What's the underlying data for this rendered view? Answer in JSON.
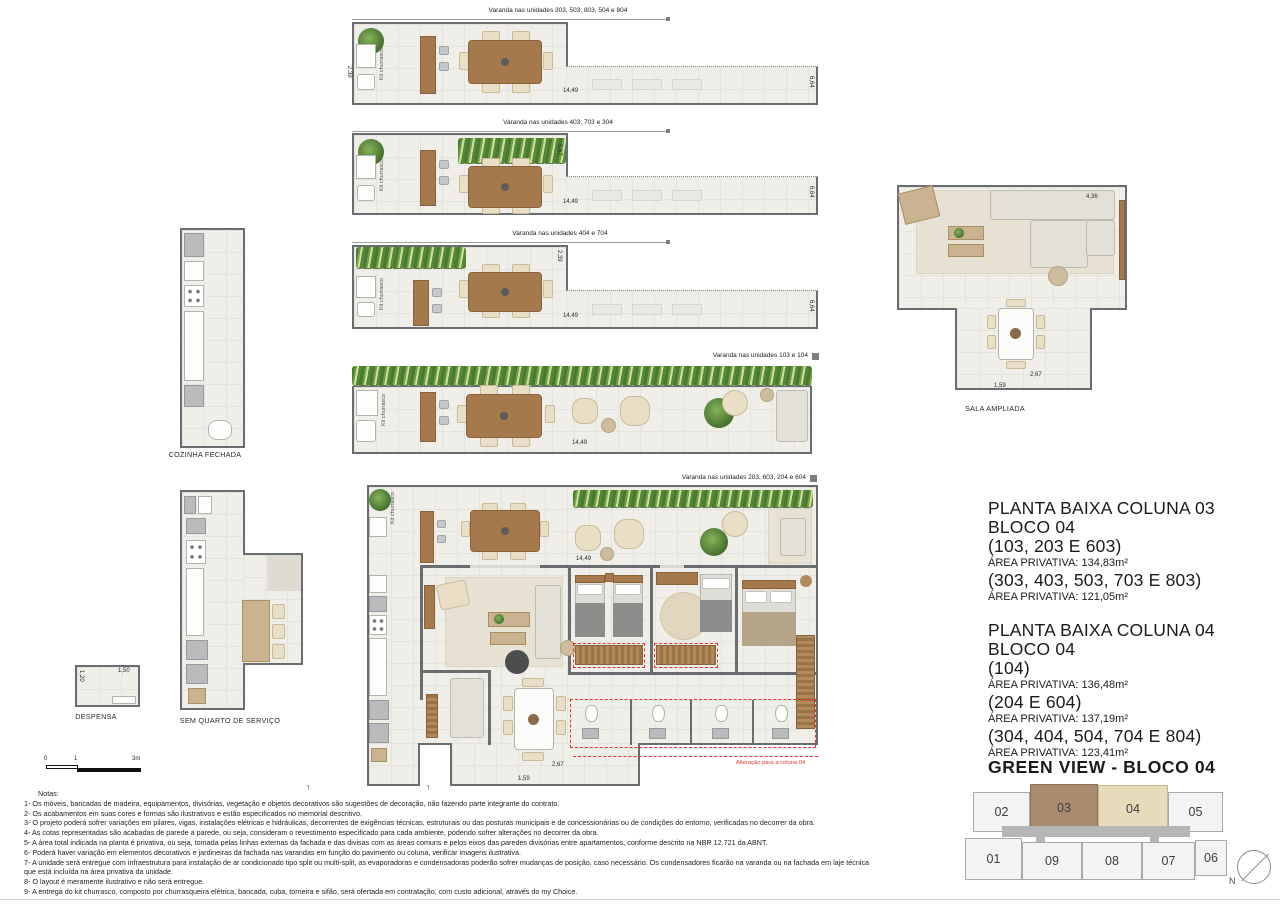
{
  "labels": {
    "varanda1": "Varanda nas unidades 303, 503, 803, 504 e 804",
    "varanda2": "Varanda nas unidades 403, 703 e 304",
    "varanda3": "Varanda nas unidades 404 e 704",
    "varanda4": "Varanda nas unidades 103 e 104",
    "varanda_main": "Varanda nas unidades 203, 603, 204 e 604",
    "kit": "Kit churrasco",
    "cozinha": "COZINHA FECHADA",
    "despensa": "DESPENSA",
    "sem_quarto": "SEM QUARTO DE SERVIÇO",
    "sala": "SALA AMPLIADA",
    "alteracao": "Alteração para a coluna 04"
  },
  "dims": {
    "d1449": "14,49",
    "d664": "6,64",
    "d567": "5,67",
    "d239": "2,39",
    "d436": "4,36",
    "d267": "2,67",
    "d159": "1,59",
    "d120": "1,20",
    "d150": "1,50"
  },
  "info": {
    "col03": {
      "title1": "PLANTA BAIXA COLUNA 03",
      "title2": "BLOCO 04",
      "entries": [
        {
          "units": "(103, 203 E 603)",
          "area": "ÁREA PRIVATIVA: 134,83m²"
        },
        {
          "units": "(303, 403, 503, 703 E 803)",
          "area": "ÁREA PRIVATIVA: 121,05m²"
        }
      ]
    },
    "col04": {
      "title1": "PLANTA BAIXA COLUNA 04",
      "title2": "BLOCO 04",
      "entries": [
        {
          "units": "(104)",
          "area": "ÁREA PRIVATIVA:  136,48m²"
        },
        {
          "units": "(204 E 604)",
          "area": "ÁREA PRIVATIVA:  137,19m²"
        },
        {
          "units": "(304, 404, 504, 704 E 804)",
          "area": "ÁREA PRIVATIVA:  123,41m²"
        }
      ]
    }
  },
  "keyplan": {
    "title": "GREEN VIEW - BLOCO 04",
    "top_row": [
      "02",
      "03",
      "04",
      "05"
    ],
    "bottom_row": [
      "01",
      "09",
      "08",
      "07",
      "06"
    ],
    "highlighted": [
      "03",
      "04"
    ],
    "north_label": "N"
  },
  "scalebar": {
    "ticks": [
      "0",
      "1",
      "3m"
    ]
  },
  "notes": {
    "title": "Notas:",
    "items": [
      "1- Os móveis, bancadas de madeira, equipamentos, divisórias, vegetação e objetos decorativos são sugestões de decoração, não fazendo parte integrante do contrato.",
      "2- Os acabamentos em suas cores e formas são ilustrativos e estão especificados no memorial descritivo.",
      "3- O projeto poderá sofrer variações em pilares, vigas, instalações elétricas e hidráulicas, decorrentes de exigências técnicas, estruturais ou das posturas municipais e de concessionárias ou de condições do entorno, verificadas no decorrer da obra.",
      "4- As cotas representadas são acabadas de parede a parede, ou seja, consideram o revestimento especificado para cada ambiente, podendo sofrer alterações no decorrer da obra.",
      "5- A área total indicada na planta é privativa, ou seja, tomada pelas linhas externas da fachada e das divisas com as áreas comuns e pelos eixos das paredes divisórias entre apartamentos, conforme descrito na NBR 12.721 da ABNT.",
      "6- Poderá haver variação em elementos decorativos e jardineiras da fachada nas varandas em função do pavimento ou coluna, verificar imagens ilustrativa.",
      "7- A unidade será entregue com infraestrutura para instalação de ar condicionado tipo split ou multi-split, as evaporadoras e condensadoras poderão sofrer mudanças de posição, caso necessário. Os condensadores ficarão na varanda ou na fachada em laje técnica que está incluída na área privativa da unidade.",
      "8- O layout é meramente ilustrativo e não será entregue.",
      "9- A entrega do kit churrasco, composto por churrasqueira elétrica, bancada, cuba, torneira e sifão, será ofertada em contratação, com custo adicional, através do my Choice."
    ]
  },
  "colors": {
    "wall": "#6a6d70",
    "accent_red": "#e5352b",
    "highlight_col03": "#a98b70",
    "highlight_col04": "#e6dcbc"
  }
}
